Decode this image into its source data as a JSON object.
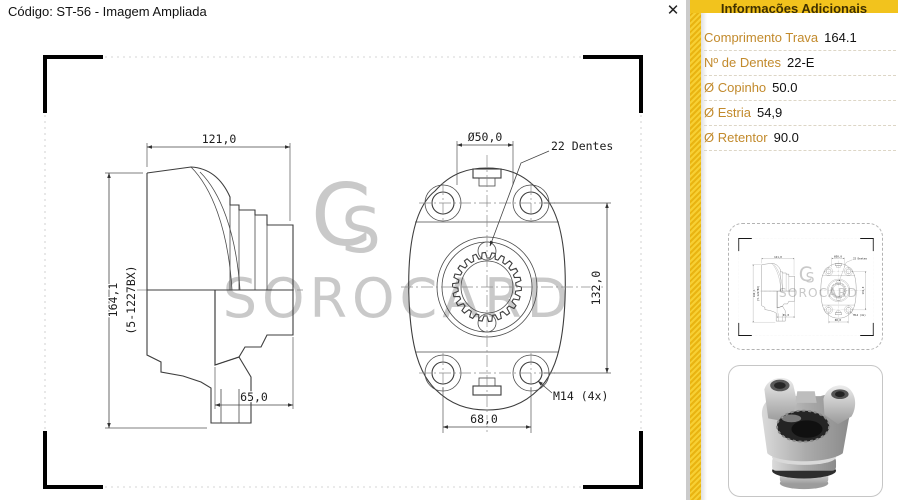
{
  "window": {
    "title": "Código: ST-56 - Imagem Ampliada",
    "close_glyph": "✕"
  },
  "watermark": {
    "text": "SOROCARD",
    "logo_c": "C",
    "logo_s": "S"
  },
  "drawing": {
    "teeth_count": 22,
    "dims": {
      "overall_width": "121,0",
      "overall_height": "164,1",
      "part_ref": "(5-1227BX)",
      "hub_length": "65,0",
      "cup_diameter": "Ø50,0",
      "spline_label": "22 Dentes",
      "bolt_vertical": "132,0",
      "thread_spec": "M14 (4x)",
      "bolt_horizontal": "68,0"
    }
  },
  "sidebar": {
    "header": "Informações Adicionais",
    "rows": [
      {
        "label": "Comprimento Trava",
        "value": "164.1"
      },
      {
        "label": "Nº de Dentes",
        "value": "22-E"
      },
      {
        "label": "Ø Copinho",
        "value": "50.0"
      },
      {
        "label": "Ø Estria",
        "value": "54,9"
      },
      {
        "label": "Ø Retentor",
        "value": "90.0"
      }
    ],
    "colors": {
      "accent_yellow": "#F2C31D",
      "label_orange": "#C28A2C"
    }
  }
}
